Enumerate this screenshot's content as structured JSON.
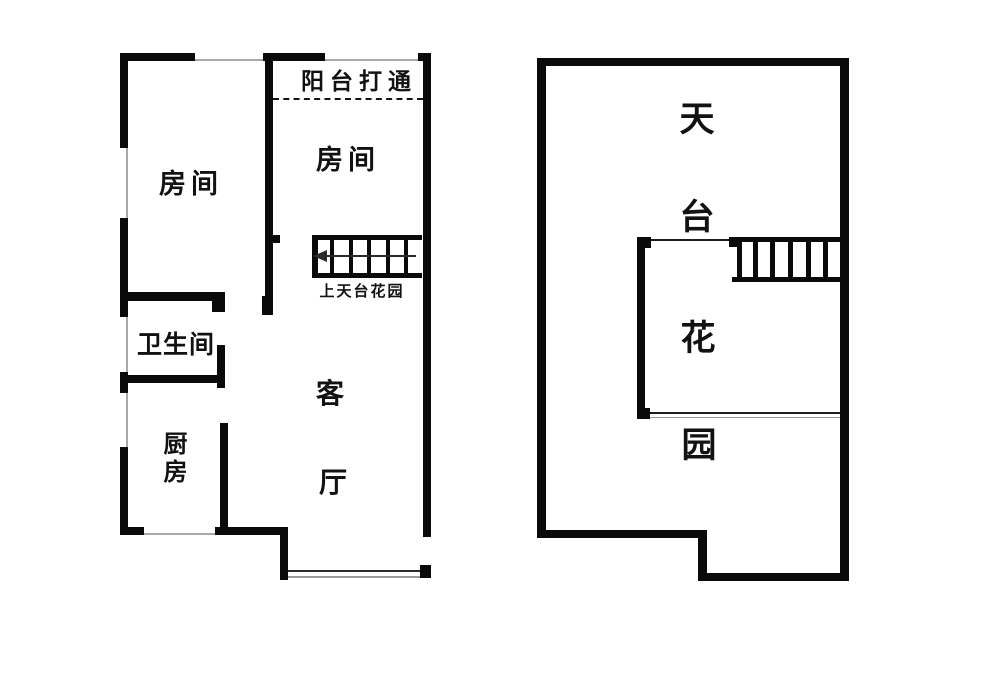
{
  "canvas": {
    "background": "#ffffff",
    "wall_color": "#0a0a0a",
    "window_line_color": "#a9a9a9",
    "text_color": "#121212"
  },
  "floor1": {
    "balcony_label": "阳台打通",
    "bedroom_left_label": "房间",
    "bedroom_right_label": "房间",
    "stair_label": "上天台花园",
    "bathroom_label": "卫生间",
    "kitchen_label": "厨房",
    "living_room_chars": [
      "客",
      "厅"
    ],
    "stair_arrow_icon": "left-arrow"
  },
  "floor2": {
    "garden_chars": [
      "天",
      "台",
      "花",
      "园"
    ]
  }
}
